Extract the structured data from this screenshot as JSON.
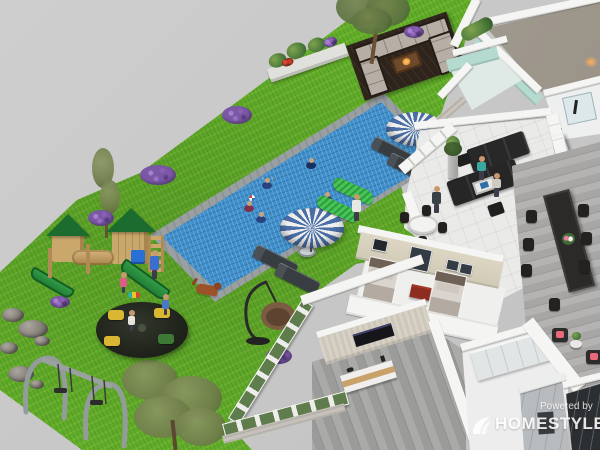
{
  "watermark": {
    "powered_by": "Powered by",
    "brand": "HOMESTYLER"
  },
  "scene": {
    "description": "Isometric 3D rendering of a residential floor plan with a landscaped backyard",
    "backyard": {
      "pool": {
        "shape": "long rectangular lap pool",
        "water_color": "#3e8fcb",
        "border_color": "#9aa0a2",
        "swimmers": 5,
        "pool_ball": 1
      },
      "lawn_color": "#61ad2a",
      "patio_lounge": {
        "deck_color": "#2e241c",
        "sofa": "U-shaped sectional with light gray cushions",
        "fire_table": 1
      },
      "umbrellas": {
        "count": 2,
        "style": "blue and white striped",
        "sun_loungers": 4,
        "side_table": 1
      },
      "green_chaise_lounges": 2,
      "planter_bench": {
        "count": 1,
        "flowers": [
          "red",
          "green",
          "purple"
        ]
      },
      "playground": {
        "play_structure": "wooden towers with green canopy roofs, tunnel and two green slides",
        "swing_set": {
          "frame": "gray metal",
          "swings": 2
        },
        "merry_go_round": {
          "base": "#23271f",
          "seat_colors": [
            "#d9b733",
            "#3e7a36"
          ],
          "riders": 2
        }
      },
      "people": {
        "children_on_lawn": 3,
        "adults_on_lawn": 2
      },
      "dog": {
        "count": 1,
        "color": "brown"
      },
      "hanging_egg_chair": 1,
      "trees": 3,
      "lavender_bushes": 6,
      "rocks": 6,
      "garden_statue_planter": 1
    },
    "house": {
      "wall_color": "#f5f5f3",
      "garden_facade": "white frames with green glass panes over light brick base",
      "rooms": [
        {
          "name": "empty-room",
          "floor": "taupe"
        },
        {
          "name": "bathroom",
          "accent_wall": "#b5dacf",
          "features": [
            "glass shower",
            "black fixture"
          ]
        },
        {
          "name": "living-room",
          "floor": "white tile",
          "furniture": [
            "dark sectional sofas",
            "coffee table",
            "ottomans",
            "tall dark cabinet",
            "round white table with black chairs",
            "floor plant"
          ],
          "occupants": 3
        },
        {
          "name": "twin-bedroom",
          "wall": "#dcd6c3",
          "furniture": [
            "two single beds",
            "red nightstand",
            "large wall art",
            "three small frames"
          ]
        },
        {
          "name": "dining-room",
          "floor": "gray wood planks",
          "furniture": [
            "long black dining table",
            "dark chairs",
            "flower centerpiece"
          ]
        },
        {
          "name": "media-room",
          "features": [
            "striped wallpaper",
            "wall-mounted TV",
            "white media console with wood drawers"
          ]
        },
        {
          "name": "closet-room",
          "features": [
            "white wardrobe cabinet wall"
          ]
        },
        {
          "name": "kitchen",
          "features": [
            "gray cabinet fronts",
            "dark glass partition"
          ]
        },
        {
          "name": "reading-corner",
          "features": [
            "dark chairs with pink cushions",
            "small plant table"
          ]
        }
      ]
    },
    "palette": {
      "ground": "#c9c9c9",
      "grass": "#61ad2a",
      "water": "#3e8fcb",
      "umbrella_blue": "#4a6fa8",
      "chaise_green": "#3db54a",
      "slide_green": "#2a8d3c",
      "lavender": "#7b58a6",
      "bedroom_wall": "#dcd6c3"
    }
  }
}
